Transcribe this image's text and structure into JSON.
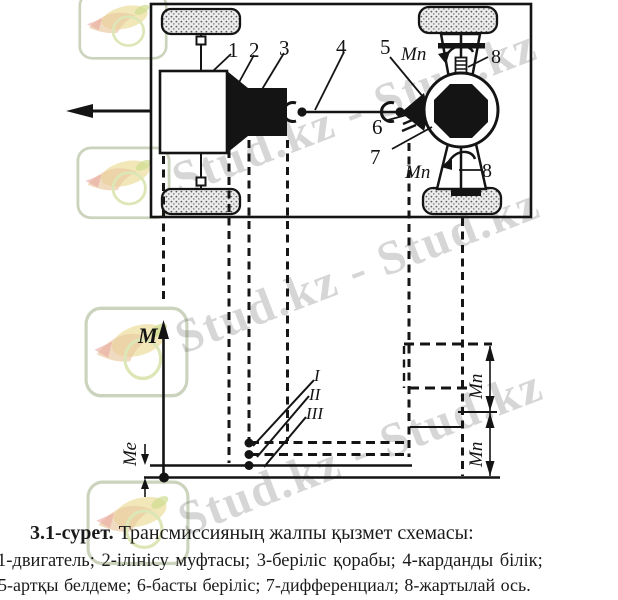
{
  "figure": {
    "caption": {
      "number": "3.1-сурет.",
      "title": " Трансмиссияның жалпы қызмет схемасы:",
      "legend_line1": "1-двигатель; 2-ілінісу муфтасы; 3-беріліс қорабы; 4-карданды білік;",
      "legend_line2": "5-артқы белдеме; 6-басты беріліс; 7-дифференциал; 8-жартылай ось."
    },
    "schematic_labels": {
      "engine": "1",
      "clutch": "2",
      "gearbox": "3",
      "driveshaft": "4",
      "rear_axle": "5",
      "final_drive": "6",
      "differential": "7",
      "half_shaft_top": "8",
      "half_shaft_bottom": "8",
      "wheel_torque_top": "Мп",
      "wheel_torque_bottom": "Мп"
    },
    "graph_labels": {
      "axis": "M",
      "engine_torque": "Ме",
      "wheel_torque_upper": "Мп",
      "wheel_torque_lower": "Мп",
      "gear_first": "I",
      "gear_second": "II",
      "gear_third": "III"
    }
  },
  "watermark": {
    "text": "Stud.kz - Stud.kz",
    "logo_name": "Stud.kz",
    "text_color": "#4a4a4a",
    "stamp_border_color": "#ccd3bd",
    "bird_body_color": "#ecdfa2",
    "bird_wing_color": "#e9c79e",
    "bird_beak_color": "#e9a9a0",
    "ring_color": "#dde6b6",
    "leaf_color": "#cfdd90"
  },
  "ink_color": "#141414",
  "background": "#ffffff"
}
